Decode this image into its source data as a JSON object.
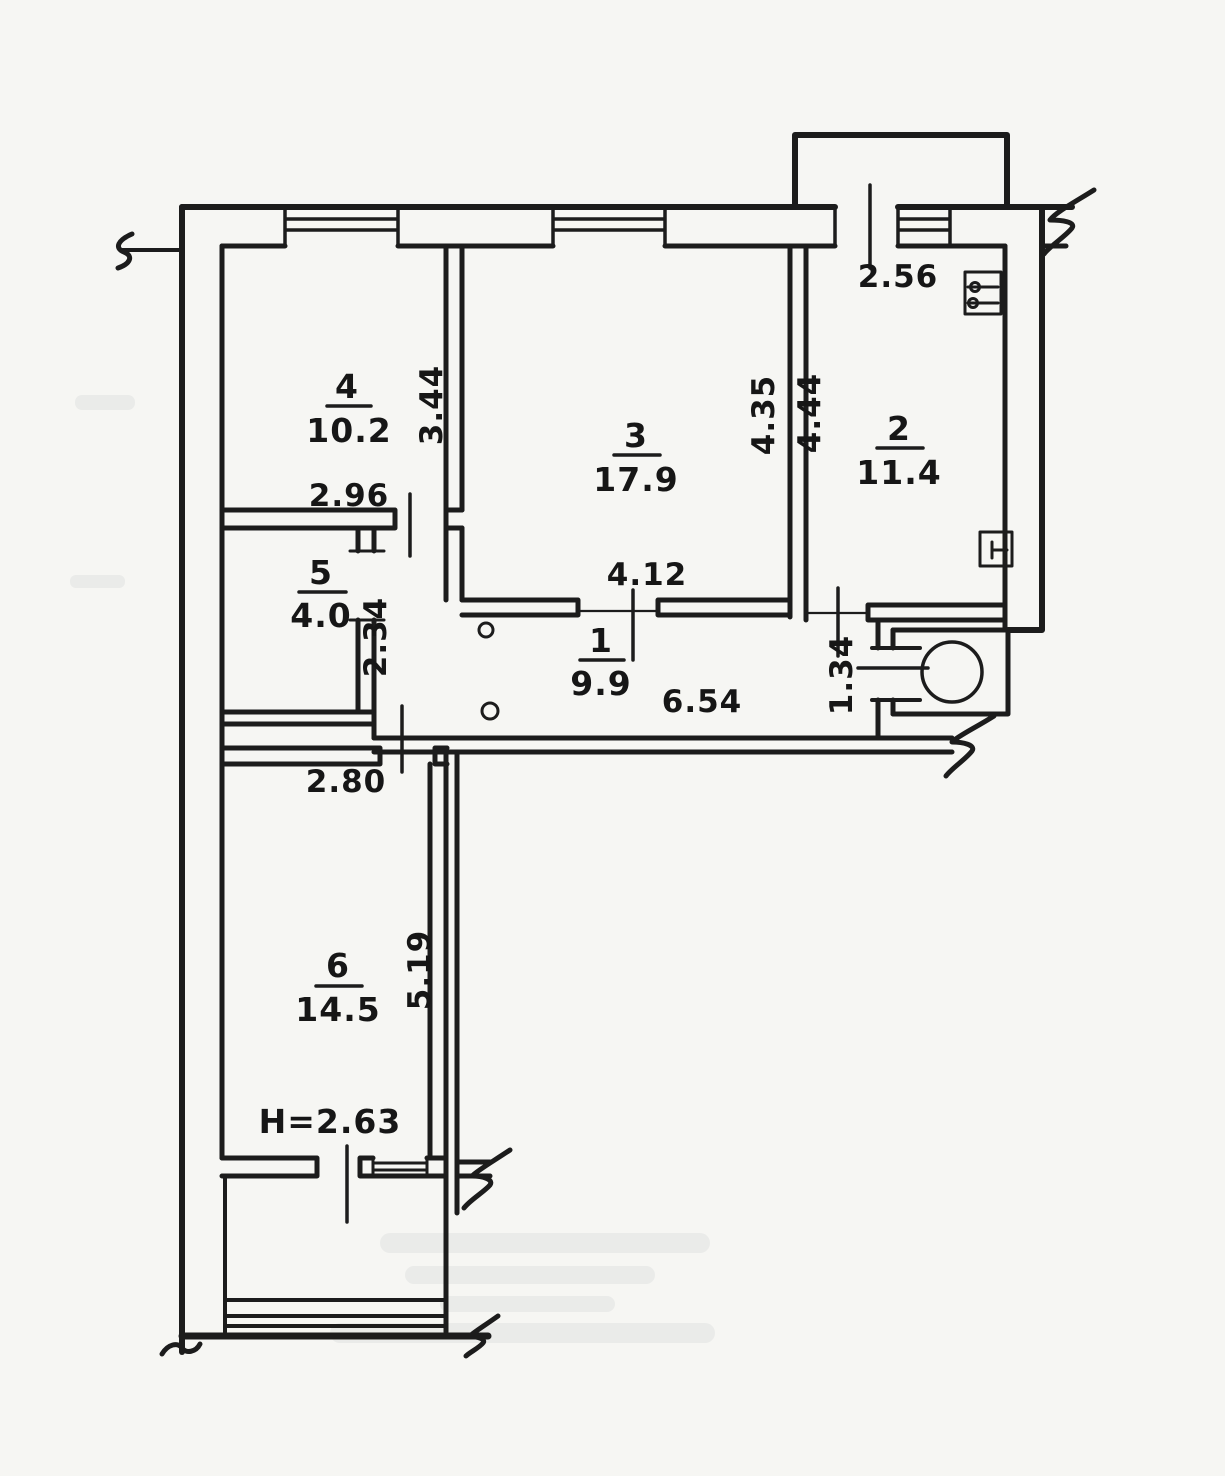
{
  "document": {
    "kind": "scanned hand-drawn apartment floor plan",
    "colors": {
      "ink": "#1c1c1c",
      "paper": "#f6f6f3"
    }
  },
  "rooms": [
    {
      "number": "4",
      "area": "10.2"
    },
    {
      "number": "3",
      "area": "17.9"
    },
    {
      "number": "2",
      "area": "11.4"
    },
    {
      "number": "5",
      "area": "4.0"
    },
    {
      "number": "1",
      "area": "9.9"
    },
    {
      "number": "6",
      "area": "14.5"
    }
  ],
  "dimensions": {
    "room4_width": "2.96",
    "room4_depth": "3.44",
    "room3_width": "4.12",
    "room3_depth": "4.35",
    "room2_width": "2.56",
    "room2_depth": "4.44",
    "room5_depth": "2.34",
    "hall_length": "6.54",
    "hall_entry_width": "1.34",
    "room6_width": "2.80",
    "room6_depth": "5.19",
    "ceiling_height": "H=2.63"
  },
  "symbols": {
    "electrical_panel": "box with two switch circles, room 2 top-right",
    "radiator_tap": "small T mark in box, room 2 bottom-right",
    "entrance_column": "circle at entrance vestibule",
    "door_knobs": "two small circles in hallway",
    "wall_breaks": "zigzag cut marks at drawing edges",
    "balconies": "top-right balcony and bottom balcony with railing lines"
  }
}
